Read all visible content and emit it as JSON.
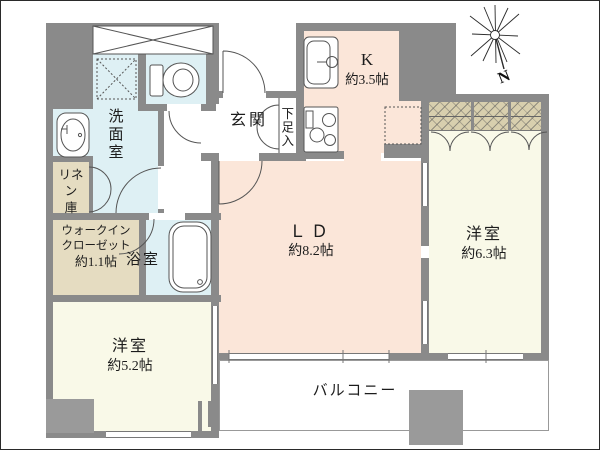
{
  "floorplan": {
    "type": "apartment-floor-plan",
    "rooms": {
      "kitchen": {
        "name": "K",
        "area": "約3.5帖"
      },
      "living_dining": {
        "name": "ＬＤ",
        "area": "約8.2帖"
      },
      "bedroom_east": {
        "name": "洋室",
        "area": "約6.3帖"
      },
      "bedroom_south": {
        "name": "洋室",
        "area": "約5.2帖"
      },
      "washroom": {
        "name": "洗面室"
      },
      "bathroom": {
        "name": "浴室"
      },
      "walk_in_closet": {
        "name_line1": "ウォークイン",
        "name_line2": "クローゼット",
        "area": "約1.1帖"
      },
      "linen_closet": {
        "name_line1": "リネン",
        "name_line2": "庫"
      },
      "entrance": {
        "name": "玄関"
      },
      "shoe_cabinet": {
        "name": "下足入"
      },
      "balcony": {
        "name": "バルコニー"
      }
    },
    "compass": {
      "label": "N"
    },
    "colors": {
      "warm_room": "#fbe6d9",
      "cream_room": "#f9f9e8",
      "wet_area": "#def0f4",
      "closet_beige": "#e5dcc1",
      "closet_hatch": "#d8cfae",
      "wall_gray": "#8a8a8a",
      "line": "#555555"
    }
  }
}
